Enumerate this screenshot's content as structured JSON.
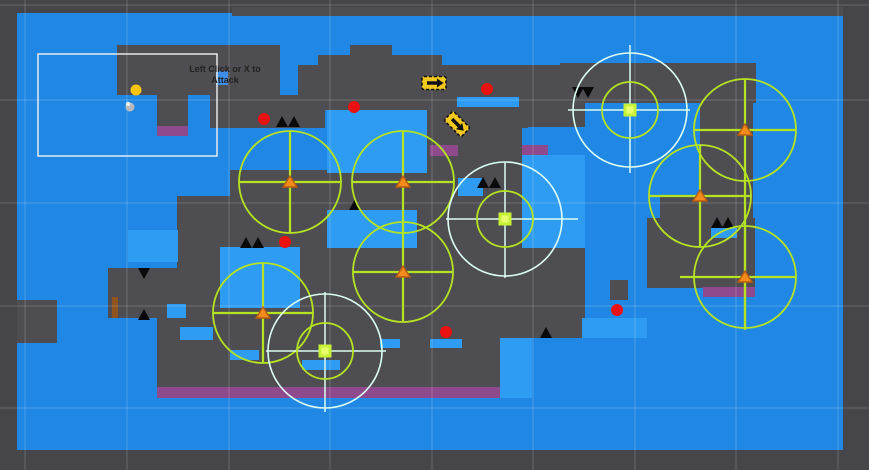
{
  "scene": {
    "hud": {
      "line1": "Left Click or X to",
      "line2": "Attack"
    },
    "colors": {
      "editor_bg": "#46464a",
      "level_blue": "#2088e4",
      "platform_gray": "#4e4e52",
      "patch_blue": "#2f9cf4",
      "hazard_purple": "#8e4a8c",
      "enemy_red": "#ea1111",
      "coin_gold": "#fcc60e",
      "gizmo_green": "#b6e321",
      "gizmo_white": "#dcfdf2",
      "marker_orange": "#f28a1c",
      "marker_outline": "#b85c10",
      "arrow_yellow": "#f2c81c",
      "spike_black": "#0a0a0a",
      "brown": "#90551e",
      "grid": "rgba(255,255,255,0.13)",
      "camera_white": "#f2f2f2",
      "hud_icon_blue": "#3e8ee8",
      "square_green": "#c8f135",
      "square_green_inner": "#e6ff6a",
      "player_gray": "#b9b9bd"
    },
    "level_area": {
      "x": 17,
      "y": 13,
      "w": 826,
      "h": 437
    },
    "camera_bounds": {
      "x": 38,
      "y": 54,
      "w": 179,
      "h": 102
    },
    "grid": {
      "vertical_x": [
        25,
        127,
        229,
        330,
        432,
        533,
        635,
        736,
        838
      ],
      "horizontal_y": [
        5,
        100,
        203,
        306,
        408
      ]
    },
    "platforms": [
      [
        232,
        7,
        611,
        9
      ],
      [
        117,
        45,
        163,
        50
      ],
      [
        210,
        95,
        115,
        33
      ],
      [
        157,
        95,
        31,
        31
      ],
      [
        350,
        45,
        42,
        12
      ],
      [
        318,
        55,
        124,
        12
      ],
      [
        298,
        65,
        235,
        45
      ],
      [
        427,
        103,
        101,
        25
      ],
      [
        528,
        65,
        57,
        62
      ],
      [
        560,
        63,
        196,
        40
      ],
      [
        230,
        170,
        97,
        78
      ],
      [
        327,
        173,
        195,
        40
      ],
      [
        417,
        213,
        105,
        35
      ],
      [
        427,
        128,
        95,
        67
      ],
      [
        458,
        195,
        64,
        53
      ],
      [
        300,
        247,
        285,
        91
      ],
      [
        177,
        196,
        53,
        72
      ],
      [
        108,
        268,
        122,
        50
      ],
      [
        157,
        308,
        343,
        79
      ],
      [
        700,
        75,
        53,
        155
      ],
      [
        660,
        195,
        40,
        35
      ],
      [
        647,
        218,
        108,
        70
      ],
      [
        17,
        300,
        40,
        43
      ],
      [
        610,
        280,
        18,
        20
      ]
    ],
    "blue_patches": [
      [
        327,
        110,
        100,
        63
      ],
      [
        327,
        210,
        90,
        38
      ],
      [
        220,
        247,
        80,
        61
      ],
      [
        128,
        230,
        50,
        32
      ],
      [
        522,
        155,
        63,
        93
      ],
      [
        582,
        318,
        65,
        20
      ],
      [
        500,
        338,
        32,
        60
      ],
      [
        457,
        97,
        62,
        10
      ],
      [
        167,
        304,
        19,
        14
      ],
      [
        180,
        327,
        33,
        13
      ],
      [
        230,
        350,
        29,
        10
      ],
      [
        302,
        360,
        38,
        10
      ],
      [
        380,
        339,
        20,
        9
      ],
      [
        430,
        339,
        32,
        9
      ],
      [
        711,
        228,
        26,
        10
      ],
      [
        458,
        178,
        25,
        18
      ]
    ],
    "purple_strips": [
      [
        157,
        126,
        31,
        10
      ],
      [
        430,
        145,
        28,
        11
      ],
      [
        522,
        145,
        26,
        10
      ],
      [
        157,
        387,
        343,
        11
      ],
      [
        703,
        287,
        52,
        10
      ]
    ],
    "brown_bars": [
      [
        112,
        297,
        6,
        21
      ]
    ],
    "spikes_up": [
      [
        276,
        116
      ],
      [
        288,
        116
      ],
      [
        240,
        237
      ],
      [
        252,
        237
      ],
      [
        349,
        199
      ],
      [
        477,
        177
      ],
      [
        489,
        177
      ],
      [
        138,
        309
      ],
      [
        540,
        327
      ],
      [
        711,
        217
      ],
      [
        722,
        217
      ]
    ],
    "spikes_down": [
      [
        138,
        268
      ],
      [
        572,
        87
      ],
      [
        582,
        87
      ]
    ],
    "spike_size": {
      "w": 12,
      "h": 11
    },
    "enemy_balls": [
      [
        264,
        119
      ],
      [
        354,
        107
      ],
      [
        487,
        89
      ],
      [
        285,
        242
      ],
      [
        446,
        332
      ],
      [
        617,
        310
      ]
    ],
    "ball_radius": 6,
    "coin": {
      "x": 136,
      "y": 90,
      "r": 5.5
    },
    "player": {
      "x": 130,
      "y": 107
    },
    "boost_arrows": [
      {
        "x": 434,
        "y": 83,
        "rot": 0
      },
      {
        "x": 457,
        "y": 124,
        "rot": 45
      }
    ],
    "hud_icon": {
      "x": 216,
      "y": 71,
      "w": 12,
      "h": 14
    },
    "range_gizmos": [
      {
        "cx": 290,
        "cy": 182,
        "r": 51,
        "v": [
          131,
          233
        ],
        "h": [
          239,
          341
        ]
      },
      {
        "cx": 403,
        "cy": 182,
        "r": 51,
        "v": [
          131,
          233
        ],
        "h": [
          352,
          454
        ]
      },
      {
        "cx": 403,
        "cy": 272,
        "r": 50,
        "v": [
          222,
          322
        ],
        "h": [
          353,
          453
        ]
      },
      {
        "cx": 263,
        "cy": 313,
        "r": 50,
        "v": [
          263,
          363
        ],
        "h": [
          213,
          313
        ]
      },
      {
        "cx": 745,
        "cy": 130,
        "r": 51,
        "v": [
          79,
          330
        ],
        "h": [
          694,
          796
        ]
      },
      {
        "cx": 700,
        "cy": 196,
        "r": 51,
        "v": [
          145,
          247
        ],
        "h": [
          649,
          751
        ]
      },
      {
        "cx": 745,
        "cy": 277,
        "r": 51,
        "v": [
          226,
          328
        ],
        "h": [
          680,
          795
        ]
      }
    ],
    "selected_gizmos": [
      {
        "cx": 505,
        "cy": 219,
        "ro": 57,
        "ri": 28,
        "v": [
          162,
          278
        ],
        "h": [
          446,
          578
        ]
      },
      {
        "cx": 630,
        "cy": 110,
        "ro": 57,
        "ri": 28,
        "v": [
          45,
          173
        ],
        "h": [
          568,
          690
        ]
      },
      {
        "cx": 325,
        "cy": 351,
        "ro": 57,
        "ri": 28,
        "v": [
          292,
          412
        ],
        "h": [
          266,
          386
        ]
      }
    ],
    "selected_square_size": 13
  }
}
